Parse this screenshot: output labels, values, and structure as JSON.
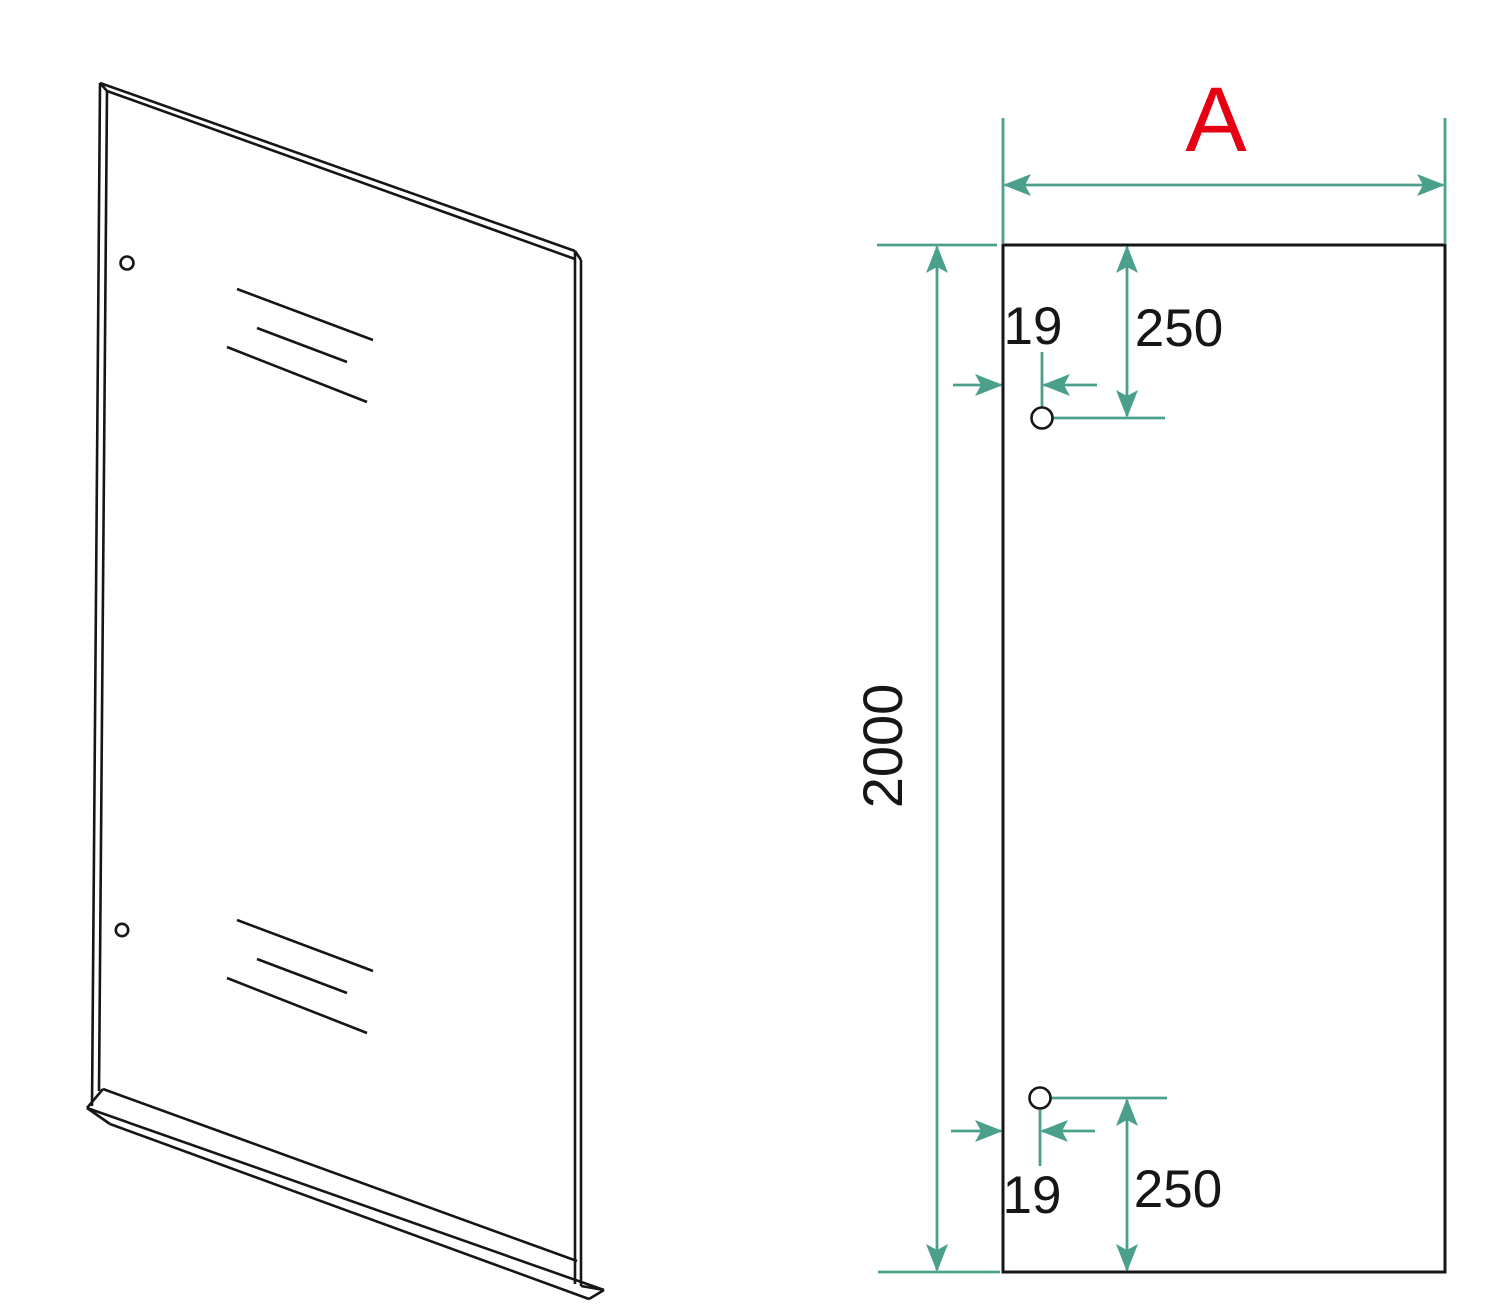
{
  "drawing": {
    "title": "Glass panel dimension drawing",
    "labels": {
      "width": "A",
      "height": "2000",
      "top_hole": {
        "offset_x": "19",
        "offset_y": "250"
      },
      "bottom_hole": {
        "offset_x": "19",
        "offset_y": "250"
      }
    },
    "colors": {
      "dimension_line": "#4ba08c",
      "width_label": "#e60013",
      "drawing_line": "#161616",
      "background": "#ffffff"
    }
  }
}
